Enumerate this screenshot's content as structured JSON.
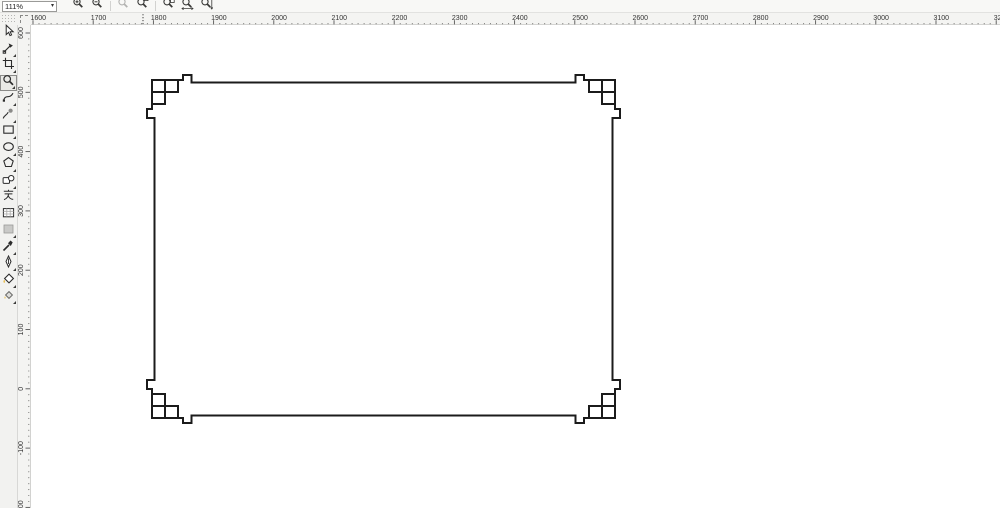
{
  "property_bar": {
    "zoom_level": "111%",
    "buttons": [
      {
        "name": "zoom-in",
        "icon": "magnifier-plus-icon",
        "disabled": false,
        "sep_before": false
      },
      {
        "name": "zoom-out",
        "icon": "magnifier-minus-icon",
        "disabled": false,
        "sep_before": false
      },
      {
        "name": "zoom-to-selection",
        "icon": "magnifier-selection-icon",
        "disabled": true,
        "sep_before": true
      },
      {
        "name": "zoom-to-all-objects",
        "icon": "magnifier-objects-icon",
        "disabled": false,
        "sep_before": false
      },
      {
        "name": "zoom-to-page",
        "icon": "magnifier-page-icon",
        "disabled": false,
        "sep_before": true
      },
      {
        "name": "zoom-to-page-width",
        "icon": "magnifier-page-width-icon",
        "disabled": false,
        "sep_before": false
      },
      {
        "name": "zoom-to-page-height",
        "icon": "magnifier-page-height-icon",
        "disabled": false,
        "sep_before": false
      }
    ]
  },
  "rulers": {
    "horizontal": {
      "labels": [
        1600,
        1700,
        1800,
        1900,
        2000,
        2100,
        2200,
        2300,
        2400,
        2500,
        2600,
        2700,
        2800,
        2900,
        3000,
        3100,
        3200
      ],
      "origin_x": 33,
      "step_px": 60.2,
      "marker_x": 143
    },
    "vertical": {
      "labels": [
        600,
        500,
        400,
        300,
        200,
        100,
        0,
        -100,
        -200
      ],
      "origin_y": 33,
      "step_px": 59.3
    }
  },
  "toolbox": {
    "tools": [
      {
        "name": "pick-tool",
        "selected": false,
        "flyout": false
      },
      {
        "name": "shape-tool",
        "selected": false,
        "flyout": true
      },
      {
        "name": "crop-tool",
        "selected": false,
        "flyout": true
      },
      {
        "name": "zoom-tool",
        "selected": true,
        "flyout": true
      },
      {
        "name": "freehand-tool",
        "selected": false,
        "flyout": true
      },
      {
        "name": "smart-fill-tool",
        "selected": false,
        "flyout": true
      },
      {
        "name": "rectangle-tool",
        "selected": false,
        "flyout": true
      },
      {
        "name": "ellipse-tool",
        "selected": false,
        "flyout": true
      },
      {
        "name": "polygon-tool",
        "selected": false,
        "flyout": true
      },
      {
        "name": "basic-shapes-tool",
        "selected": false,
        "flyout": true
      },
      {
        "name": "text-tool",
        "selected": false,
        "flyout": false
      },
      {
        "name": "table-tool",
        "selected": false,
        "flyout": false
      },
      {
        "name": "dimension-tool",
        "selected": false,
        "flyout": true
      },
      {
        "name": "eyedropper-tool",
        "selected": false,
        "flyout": true
      },
      {
        "name": "outline-pen-tool",
        "selected": false,
        "flyout": true
      },
      {
        "name": "fill-tool",
        "selected": false,
        "flyout": true
      },
      {
        "name": "interactive-fill-tool",
        "selected": false,
        "flyout": true
      }
    ]
  },
  "canvas": {
    "drawing": {
      "description": "Black rectangular frame with Chinese fret (hui-wen) knot ornaments at all four corners on a white page",
      "stroke": "#1b1b1b",
      "stroke_width": 2,
      "frame": {
        "left": 154.5,
        "top": 82.5,
        "right": 612.5,
        "bottom": 415.5
      },
      "border_gap": {
        "x": 191.5,
        "y": 118
      },
      "corner_path": "M152,80 H178 M152,92 H178 M152,104 H165 M152,80 V104 M165,80 V104 M178,80 V92 M178,80 H183 V75 H191.5 V82.5 M152,104 V109 H147 V118 H154.5"
    }
  }
}
